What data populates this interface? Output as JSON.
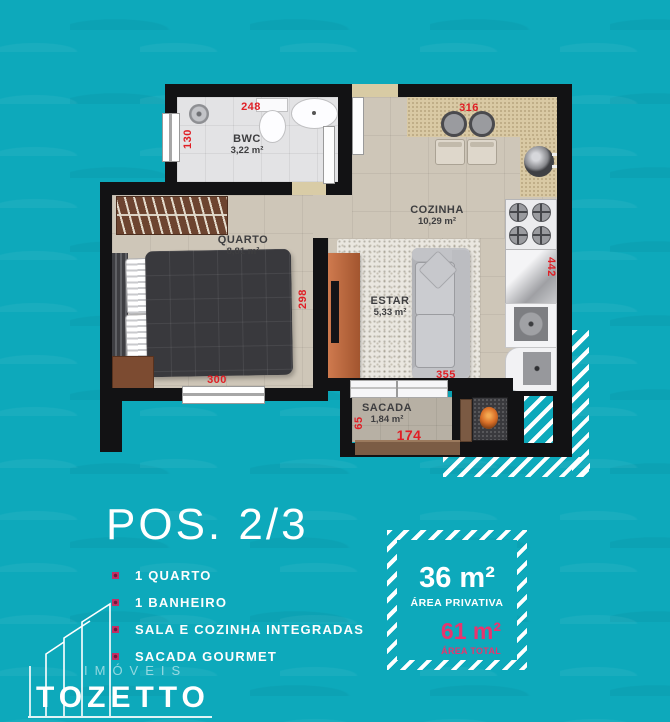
{
  "colors": {
    "background": "#0da9bb",
    "accent_pink": "#e8346e",
    "dimension_red": "#e01e25"
  },
  "plan": {
    "rooms": {
      "bwc": {
        "name": "BWC",
        "area": "3,22 m²"
      },
      "cozinha": {
        "name": "COZINHA",
        "area": "10,29 m²"
      },
      "quarto": {
        "name": "QUARTO",
        "area": "8,81 m²"
      },
      "estar": {
        "name": "ESTAR",
        "area": "5,33 m²"
      },
      "sacada": {
        "name": "SACADA",
        "area": "1,84 m²"
      }
    },
    "dims": {
      "bwc_width": "248",
      "bwc_depth": "130",
      "cozinha_width": "316",
      "cozinha_depth": "442",
      "quarto_width": "300",
      "quarto_depth": "298",
      "estar_width": "355",
      "sacada_depth": "65",
      "sacada_width": "174"
    }
  },
  "info": {
    "position_title": "POS. 2/3",
    "features": [
      {
        "label": "1 QUARTO"
      },
      {
        "label": "1 BANHEIRO"
      },
      {
        "label": "SALA E COZINHA INTEGRADAS"
      },
      {
        "label": "SACADA GOURMET"
      }
    ],
    "area_card": {
      "private_value": "36 m²",
      "private_label": "ÁREA PRIVATIVA",
      "total_value": "61 m²",
      "total_label": "ÁREA TOTAL"
    }
  },
  "brand": {
    "tagline": "IMÓVEIS",
    "name": "TOZETTO"
  }
}
